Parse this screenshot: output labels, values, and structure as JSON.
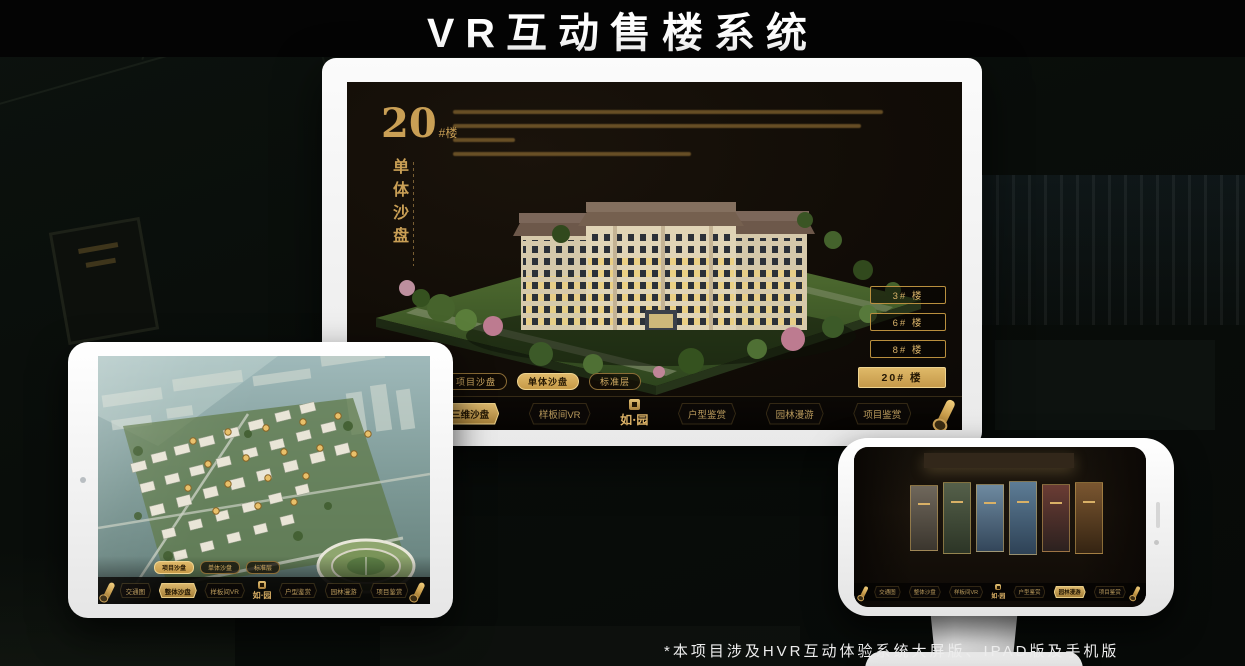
{
  "page": {
    "title": "VR互动售楼系统",
    "footnote": "*本项目涉及HVR互动体验系统大屏版、IPAD版及手机版"
  },
  "brand": {
    "logo_text": "如·园"
  },
  "colors": {
    "gold": "#c9a254",
    "gold_bright": "#e3bc6e",
    "screen_bg": "#120d07",
    "device_white": "#f5f5f5"
  },
  "monitor": {
    "heading": {
      "number": "20",
      "suffix": "#楼",
      "subtitle_vertical": "单体沙盘"
    },
    "floor_buttons": [
      {
        "label": "3# 楼",
        "active": false
      },
      {
        "label": "6# 楼",
        "active": false
      },
      {
        "label": "8# 楼",
        "active": false
      },
      {
        "label": "20# 楼",
        "active": true
      }
    ],
    "sub_tabs": [
      {
        "label": "项目沙盘",
        "active": false
      },
      {
        "label": "单体沙盘",
        "active": true
      },
      {
        "label": "标准层",
        "active": false
      }
    ],
    "nav_items": [
      {
        "label": "交通图",
        "active": false
      },
      {
        "label": "三维沙盘",
        "active": true
      },
      {
        "label": "样板间VR",
        "active": false
      },
      {
        "label": "户型鉴赏",
        "active": false
      },
      {
        "label": "园林漫游",
        "active": false
      },
      {
        "label": "项目鉴赏",
        "active": false
      }
    ]
  },
  "ipad": {
    "sub_tabs": [
      {
        "label": "项目沙盘",
        "active": true
      },
      {
        "label": "单体沙盘",
        "active": false
      },
      {
        "label": "标准层",
        "active": false
      }
    ],
    "nav_items": [
      {
        "label": "交通图",
        "active": false
      },
      {
        "label": "整体沙盘",
        "active": true
      },
      {
        "label": "样板间VR",
        "active": false
      },
      {
        "label": "户型鉴赏",
        "active": false
      },
      {
        "label": "园林漫游",
        "active": false
      },
      {
        "label": "项目鉴赏",
        "active": false
      }
    ]
  },
  "phone": {
    "nav_items": [
      {
        "label": "交通图",
        "active": false
      },
      {
        "label": "整体沙盘",
        "active": false
      },
      {
        "label": "样板间VR",
        "active": false
      },
      {
        "label": "户型鉴赏",
        "active": false
      },
      {
        "label": "园林漫游",
        "active": true
      },
      {
        "label": "项目鉴赏",
        "active": false
      }
    ]
  }
}
